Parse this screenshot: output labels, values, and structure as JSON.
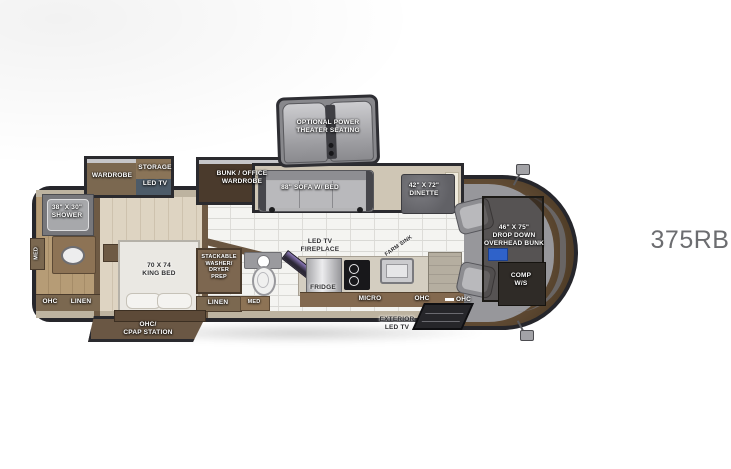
{
  "model_label": "375RB",
  "bedroom_slide": {
    "wardrobe": "WARDROBE",
    "storage": "STORAGE",
    "led_tv": "LED TV"
  },
  "bunk_slide": {
    "line1": "BUNK / OFFICE",
    "line2": "WARDROBE"
  },
  "theater": {
    "line1": "OPTIONAL POWER",
    "line2": "THEATER SEATING"
  },
  "living_slide": {
    "sofa": "88\" SOFA W/ BED",
    "dinette_size": "42\" X 72\"",
    "dinette": "DINETTE"
  },
  "rear_bath": {
    "shower_size": "38\" X 30\"",
    "shower": "SHOWER",
    "med": "MED",
    "ohc": "OHC",
    "linen": "LINEN"
  },
  "bedroom": {
    "bed_size": "70 X 74",
    "bed": "KING BED",
    "cpap1": "OHC/",
    "cpap2": "CPAP STATION"
  },
  "laundry": {
    "l1": "STACKABLE",
    "l2": "WASHER/",
    "l3": "DRYER",
    "l4": "PREP",
    "linen": "LINEN",
    "med": "MED"
  },
  "kitchen": {
    "fireplace1": "LED TV",
    "fireplace2": "FIREPLACE",
    "fridge": "FRIDGE",
    "sink": "FARM SINK",
    "micro": "MICRO",
    "ohc1": "OHC",
    "ohc2": "OHC",
    "ext1": "EXTERIOR",
    "ext2": "LED TV"
  },
  "front": {
    "bunk1": "46\" X 75\"",
    "bunk2": "DROP DOWN",
    "bunk3": "OVERHEAD BUNK",
    "comp1": "COMP",
    "comp2": "W/S"
  }
}
